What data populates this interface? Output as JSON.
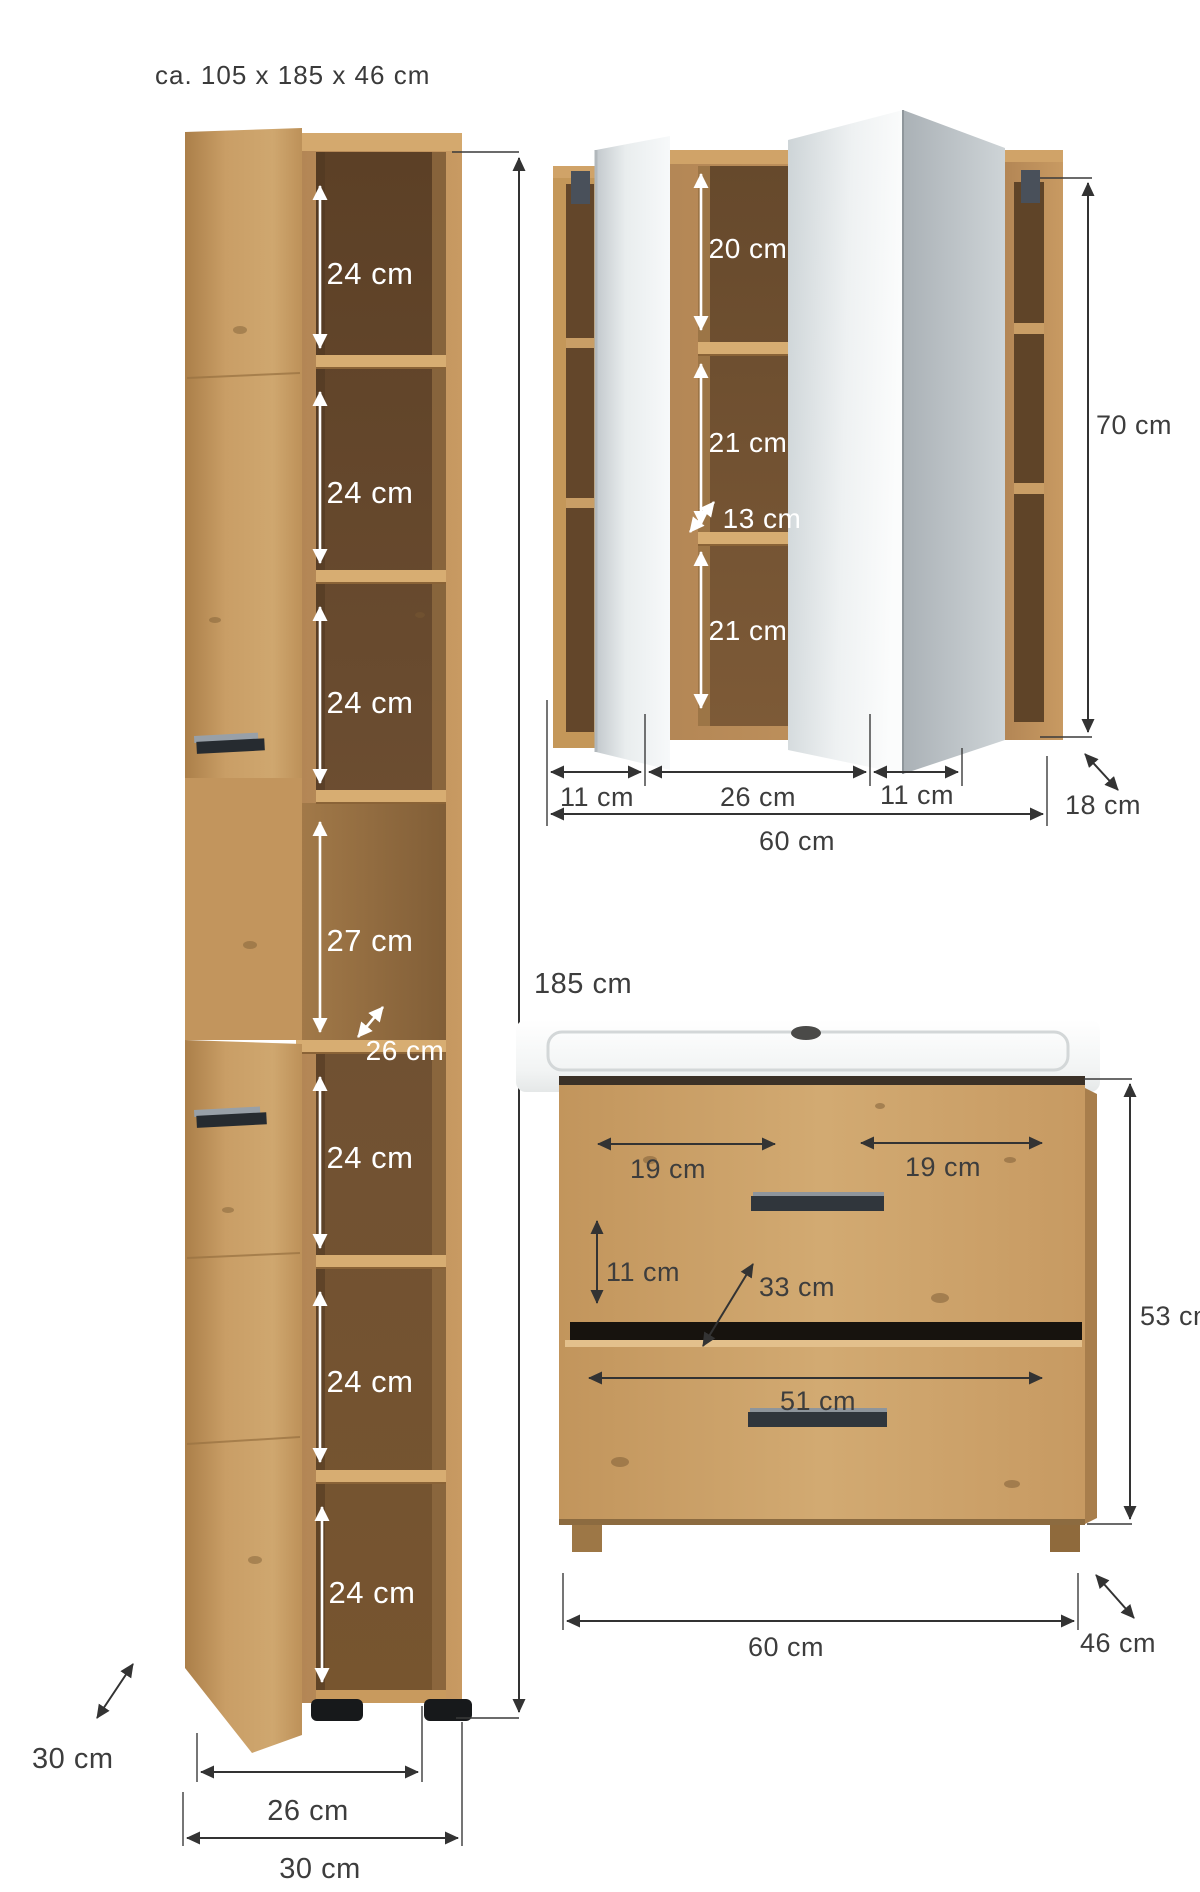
{
  "title": "ca. 105  x 185 x 46 cm",
  "colors": {
    "wood": "#c99c63",
    "wood_dark": "#a97f4b",
    "interior_dark": "#6f5033",
    "mirror_gray": "#dfe4e6",
    "handle_dark": "#30363c",
    "dimension_text": "#3d3d3d",
    "white_text": "#ffffff"
  },
  "tall_cabinet": {
    "compartments": [
      "24 cm",
      "24 cm",
      "24 cm",
      "27 cm",
      "24 cm",
      "24 cm",
      "24 cm"
    ],
    "niche_depth": "26 cm",
    "side_depth": "30 cm",
    "inner_width": "26 cm",
    "outer_width": "30 cm"
  },
  "overall": {
    "total_height": "185 cm"
  },
  "mirror_cabinet": {
    "top_section": "20 cm",
    "middle_section": "21 cm",
    "shelf_depth": "13 cm",
    "bottom_section": "21 cm",
    "height": "70 cm",
    "depth": "18 cm",
    "left_width": "11 cm",
    "center_width": "26 cm",
    "right_width": "11 cm",
    "total_width": "60 cm"
  },
  "vanity": {
    "left_half": "19 cm",
    "right_half": "19 cm",
    "inner_height": "11 cm",
    "inner_depth": "33 cm",
    "drawer_width": "51 cm",
    "height": "53 cm",
    "width": "60 cm",
    "depth": "46 cm"
  }
}
